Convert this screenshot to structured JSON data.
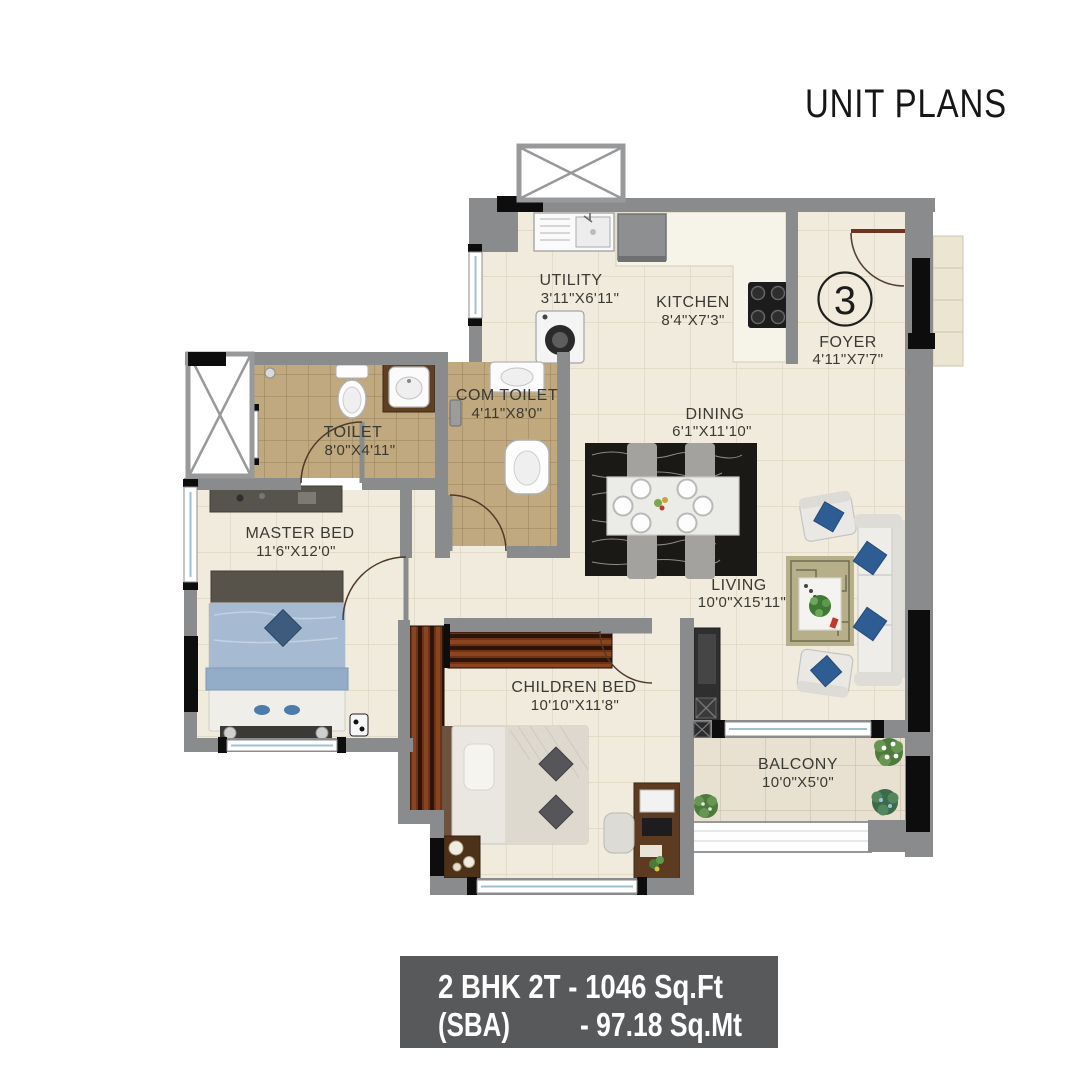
{
  "title": "UNIT PLANS",
  "unit_number": "3",
  "rooms": {
    "utility": {
      "name": "UTILITY",
      "dims": "3'11\"X6'11\""
    },
    "kitchen": {
      "name": "KITCHEN",
      "dims": "8'4\"X7'3\""
    },
    "foyer": {
      "name": "FOYER",
      "dims": "4'11\"X7'7\""
    },
    "toilet": {
      "name": "TOILET",
      "dims": "8'0\"X4'11\""
    },
    "com_toilet": {
      "name": "COM TOILET",
      "dims": "4'11\"X8'0\""
    },
    "master_bed": {
      "name": "MASTER BED",
      "dims": "11'6\"X12'0\""
    },
    "dining": {
      "name": "DINING",
      "dims": "6'1\"X11'10\""
    },
    "living": {
      "name": "LIVING",
      "dims": "10'0\"X15'11\""
    },
    "children_bed": {
      "name": "CHILDREN BED",
      "dims": "10'10\"X11'8\""
    },
    "balcony": {
      "name": "BALCONY",
      "dims": "10'0\"X5'0\""
    }
  },
  "banner": {
    "line1": "2 BHK 2T - 1046 Sq.Ft",
    "line2_left": "(SBA)",
    "line2_right": "- 97.18 Sq.Mt"
  },
  "palette": {
    "wall_gray": "#8a8b8d",
    "floor_cream": "#f0ebdc",
    "toilet_tile": "#c0a87f",
    "balcony_tile": "#e8e0d1",
    "banner_bg": "#58595b",
    "accent_blue": "#2e5d93",
    "wood_brown": "#6e3317"
  }
}
